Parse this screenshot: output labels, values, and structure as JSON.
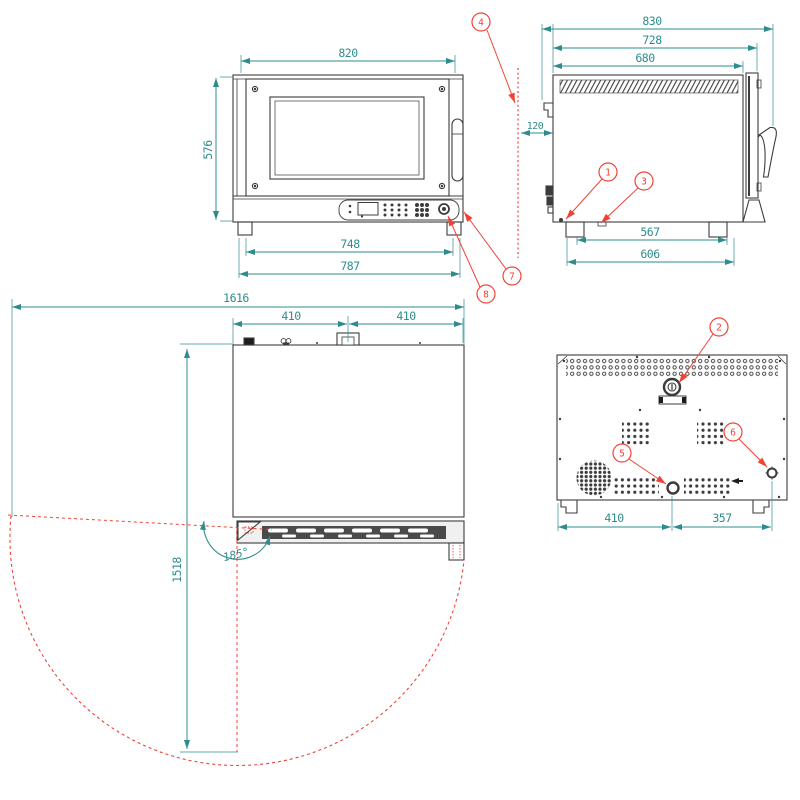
{
  "front_view": {
    "width": "820",
    "height": "576",
    "feet_inner_span": "748",
    "feet_outer_span": "787"
  },
  "side_view": {
    "overall_depth": "830",
    "door_depth": "728",
    "body_depth": "680",
    "wall_clearance": "120",
    "feet_inner_span": "567",
    "feet_outer_span": "606"
  },
  "top_view": {
    "overall_clearance_width": "1616",
    "left_half_width": "410",
    "right_half_width": "410",
    "door_swing_clearance": "1518",
    "door_open_angle": "185°"
  },
  "back_view": {
    "left_span": "410",
    "right_span": "357"
  },
  "callouts": {
    "c1": "1",
    "c2": "2",
    "c3": "3",
    "c4": "4",
    "c5": "5",
    "c6": "6",
    "c7": "7",
    "c8": "8"
  },
  "colors": {
    "dimension": "#2f8c8e",
    "callout": "#f04337",
    "line": "#3c3c3c"
  }
}
